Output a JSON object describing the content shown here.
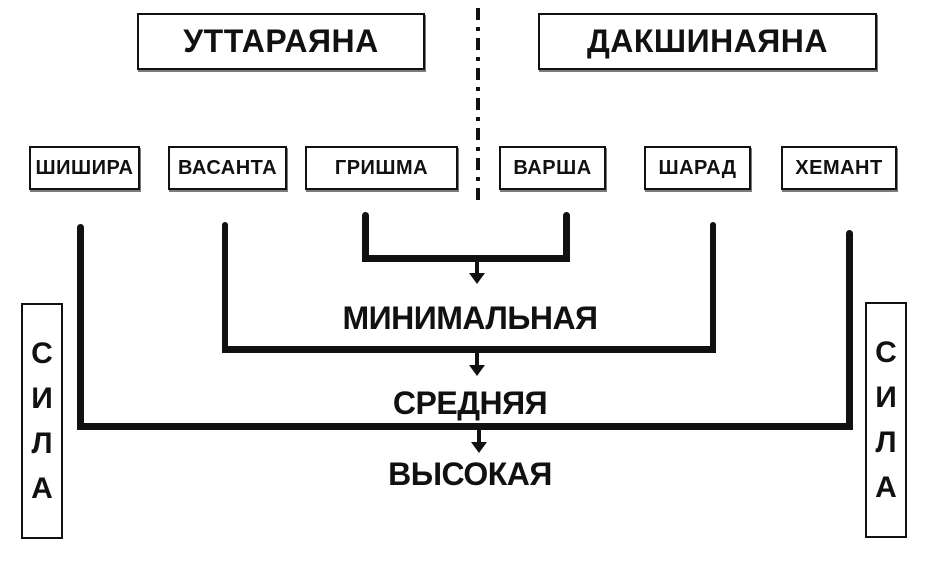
{
  "diagram": {
    "ayanas": [
      {
        "label": "УТТАРАЯНА"
      },
      {
        "label": "ДАКШИНАЯНА"
      }
    ],
    "seasons": [
      {
        "label": "ШИШИРА"
      },
      {
        "label": "ВАСАНТА"
      },
      {
        "label": "ГРИШМА"
      },
      {
        "label": "ВАРША"
      },
      {
        "label": "ШАРАД"
      },
      {
        "label": "ХЕМАНТ"
      }
    ],
    "levels": [
      {
        "label": "МИНИМАЛЬНАЯ",
        "applies_to": [
          "ГРИШМА",
          "ВАРША"
        ]
      },
      {
        "label": "СРЕДНЯЯ",
        "applies_to": [
          "ВАСАНТА",
          "ШАРАД"
        ]
      },
      {
        "label": "ВЫСОКАЯ",
        "applies_to": [
          "ШИШИРА",
          "ХЕМАНТ"
        ]
      }
    ],
    "sila": {
      "text": "СИЛА",
      "letters": [
        "С",
        "И",
        "Л",
        "А"
      ]
    },
    "colors": {
      "ink": "#111111",
      "background": "#ffffff"
    }
  }
}
